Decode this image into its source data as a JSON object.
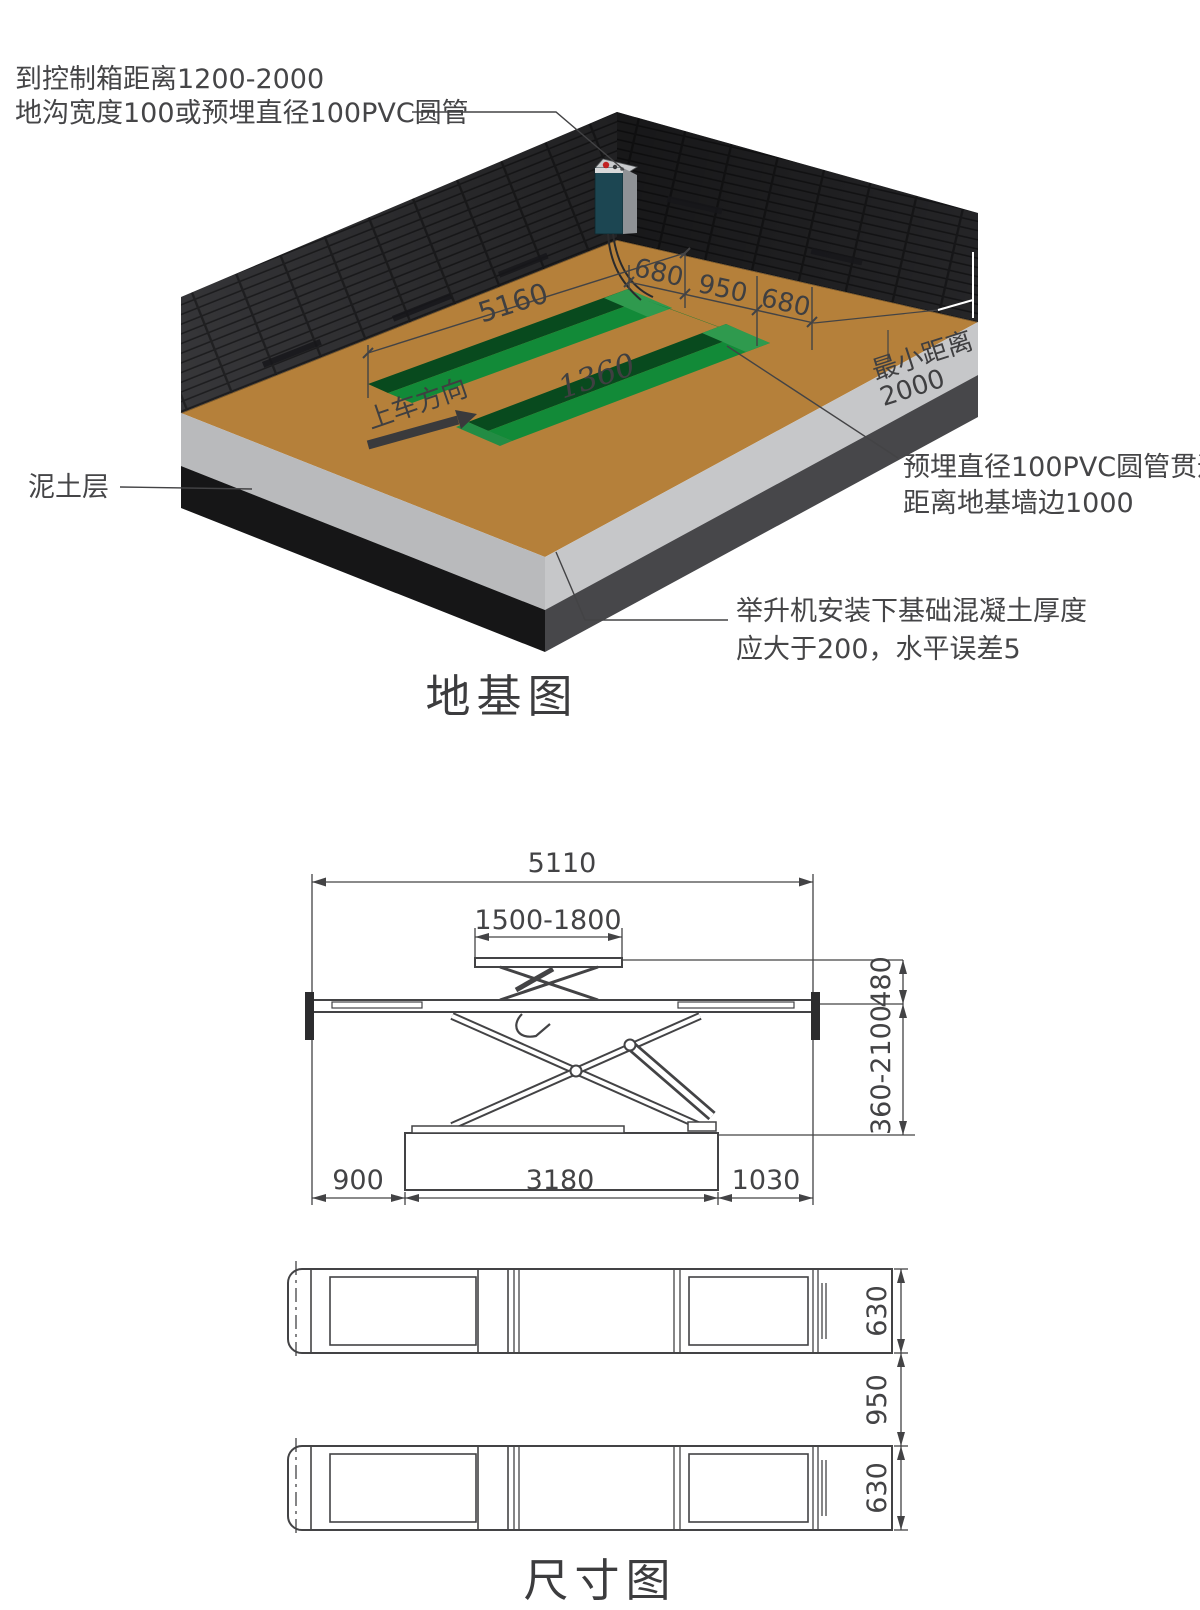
{
  "colors": {
    "floor": "#b5803a",
    "wall": "#39393c",
    "trench_green": "#0f7a31",
    "concrete": "#bcbdbf",
    "soil": "#1b1b1b",
    "line": "#434345"
  },
  "foundation": {
    "title": "地基图",
    "note_control_box": "到控制箱距离1200-2000",
    "note_trench": "地沟宽度100或预埋直径100PVC圆管",
    "note_soil": "泥土层",
    "note_pvc1": "预埋直径100PVC圆管贯通",
    "note_pvc2": "距离地基墙边1000",
    "note_concrete1": "举升机安装下基础混凝土厚度",
    "note_concrete2": "应大于200，水平误差5",
    "drive_direction": "上车方向",
    "min_distance1": "最小距离",
    "min_distance2": "2000",
    "dim_trench_length": "5160",
    "dim_trench_width_a": "680",
    "dim_gap": "950",
    "dim_trench_width_b": "680",
    "dim_inner": "1360"
  },
  "dimensions": {
    "title": "尺寸图",
    "overall_length": "5110",
    "top_platform": "1500-1800",
    "platform_height": "480",
    "lift_range": "360-2100",
    "left_offset": "900",
    "base_length": "3180",
    "right_offset": "1030",
    "platform_width_top": "630",
    "gap": "950",
    "platform_width_bottom": "630"
  }
}
